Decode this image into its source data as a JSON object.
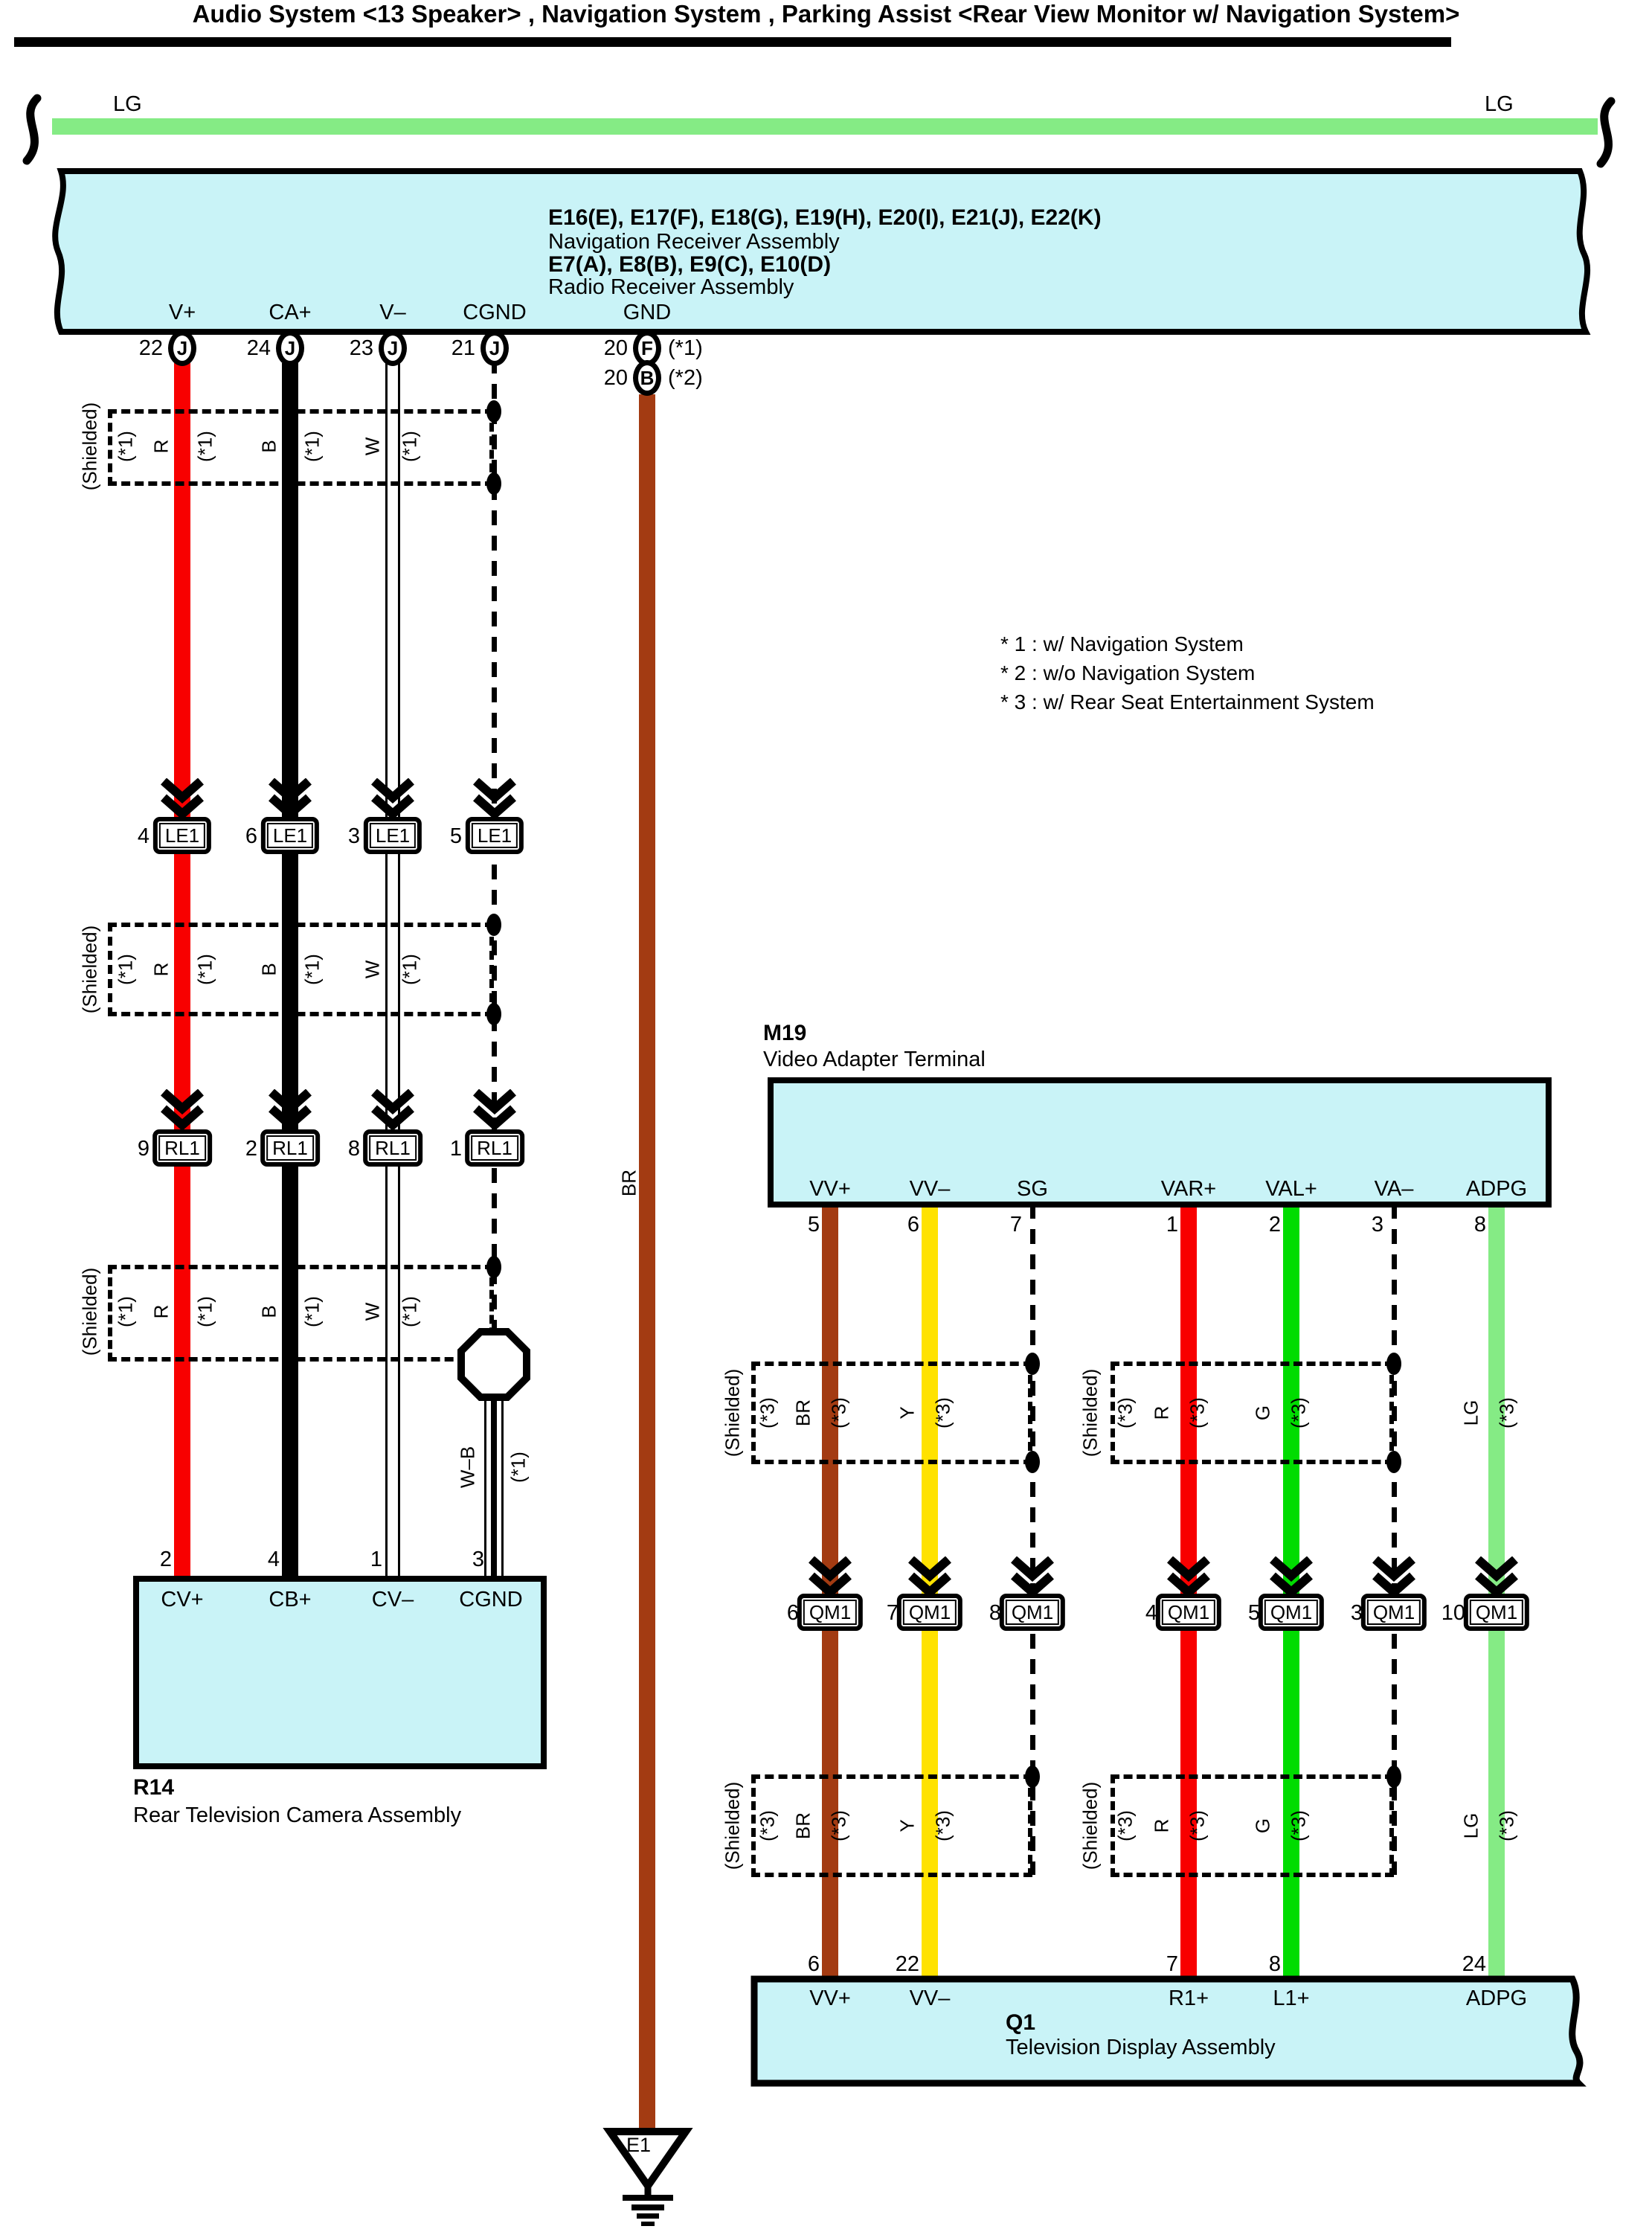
{
  "title": "Audio System <13 Speaker> , Navigation System , Parking Assist <Rear View Monitor w/ Navigation System>",
  "colors": {
    "component_fill": "#C9F3F7",
    "wire_red": "#F80000",
    "wire_black": "#000000",
    "wire_white": "#FFFFFF",
    "wire_brown": "#A33B12",
    "wire_yellow": "#FFE200",
    "wire_green": "#00DC00",
    "wire_light_green": "#85EB85"
  },
  "top_wire": {
    "left_label": "LG",
    "right_label": "LG"
  },
  "receiver_box": {
    "line1": "E16(E), E17(F), E18(G), E19(H), E20(I), E21(J), E22(K)",
    "line2": "Navigation Receiver Assembly",
    "line3": "E7(A), E8(B), E9(C), E10(D)",
    "line4": "Radio Receiver Assembly"
  },
  "receiver_pins": [
    {
      "label": "V+",
      "num": "22",
      "code": "J"
    },
    {
      "label": "CA+",
      "num": "24",
      "code": "J"
    },
    {
      "label": "V–",
      "num": "23",
      "code": "J"
    },
    {
      "label": "CGND",
      "num": "21",
      "code": "J"
    },
    {
      "label": "GND",
      "num": "20",
      "code": "F",
      "note": "(*1)"
    }
  ],
  "receiver_pin_gnd2": {
    "num": "20",
    "code": "B",
    "note": "(*2)"
  },
  "notes": [
    "* 1 : w/ Navigation System",
    "* 2 : w/o Navigation System",
    "* 3 : w/ Rear Seat Entertainment System"
  ],
  "left_shield": {
    "shielded": "(Shielded)",
    "note": "(*1)",
    "wires": [
      {
        "label": "R",
        "note": "(*1)"
      },
      {
        "label": "B",
        "note": "(*1)"
      },
      {
        "label": "W",
        "note": "(*1)"
      }
    ]
  },
  "le1_row": {
    "connector": "LE1",
    "pins": [
      "4",
      "6",
      "3",
      "5"
    ]
  },
  "rl1_row": {
    "connector": "RL1",
    "pins": [
      "9",
      "2",
      "8",
      "1"
    ]
  },
  "qm1_row": {
    "connector": "QM1",
    "pins": [
      "6",
      "7",
      "8",
      "4",
      "5",
      "3",
      "10"
    ]
  },
  "wb_wire": {
    "label": "W–B",
    "note": "(*1)"
  },
  "br_wire_label": "BR",
  "r14": {
    "code": "R14",
    "name": "Rear Television Camera Assembly",
    "pins": [
      {
        "num": "2",
        "label": "CV+"
      },
      {
        "num": "4",
        "label": "CB+"
      },
      {
        "num": "1",
        "label": "CV–"
      },
      {
        "num": "3",
        "label": "CGND"
      }
    ]
  },
  "m19": {
    "code": "M19",
    "name": "Video Adapter Terminal",
    "pins": [
      {
        "label": "VV+",
        "num": "5"
      },
      {
        "label": "VV–",
        "num": "6"
      },
      {
        "label": "SG",
        "num": "7"
      },
      {
        "label": "VAR+",
        "num": "1"
      },
      {
        "label": "VAL+",
        "num": "2"
      },
      {
        "label": "VA–",
        "num": "3"
      },
      {
        "label": "ADPG",
        "num": "8"
      }
    ]
  },
  "right_shield": {
    "shielded": "(Shielded)",
    "note": "(*3)",
    "wires": [
      {
        "label": "BR",
        "note": "(*3)"
      },
      {
        "label": "Y",
        "note": "(*3)"
      },
      {
        "label": "R",
        "note": "(*3)"
      },
      {
        "label": "G",
        "note": "(*3)"
      },
      {
        "label": "LG",
        "note": "(*3)"
      }
    ]
  },
  "q1": {
    "code": "Q1",
    "name": "Television Display Assembly",
    "pins": [
      {
        "num": "6",
        "label": "VV+"
      },
      {
        "num": "22",
        "label": "VV–"
      },
      {
        "num": "7",
        "label": "R1+"
      },
      {
        "num": "8",
        "label": "L1+"
      },
      {
        "num": "24",
        "label": "ADPG"
      }
    ]
  },
  "e1": {
    "label": "E1"
  }
}
